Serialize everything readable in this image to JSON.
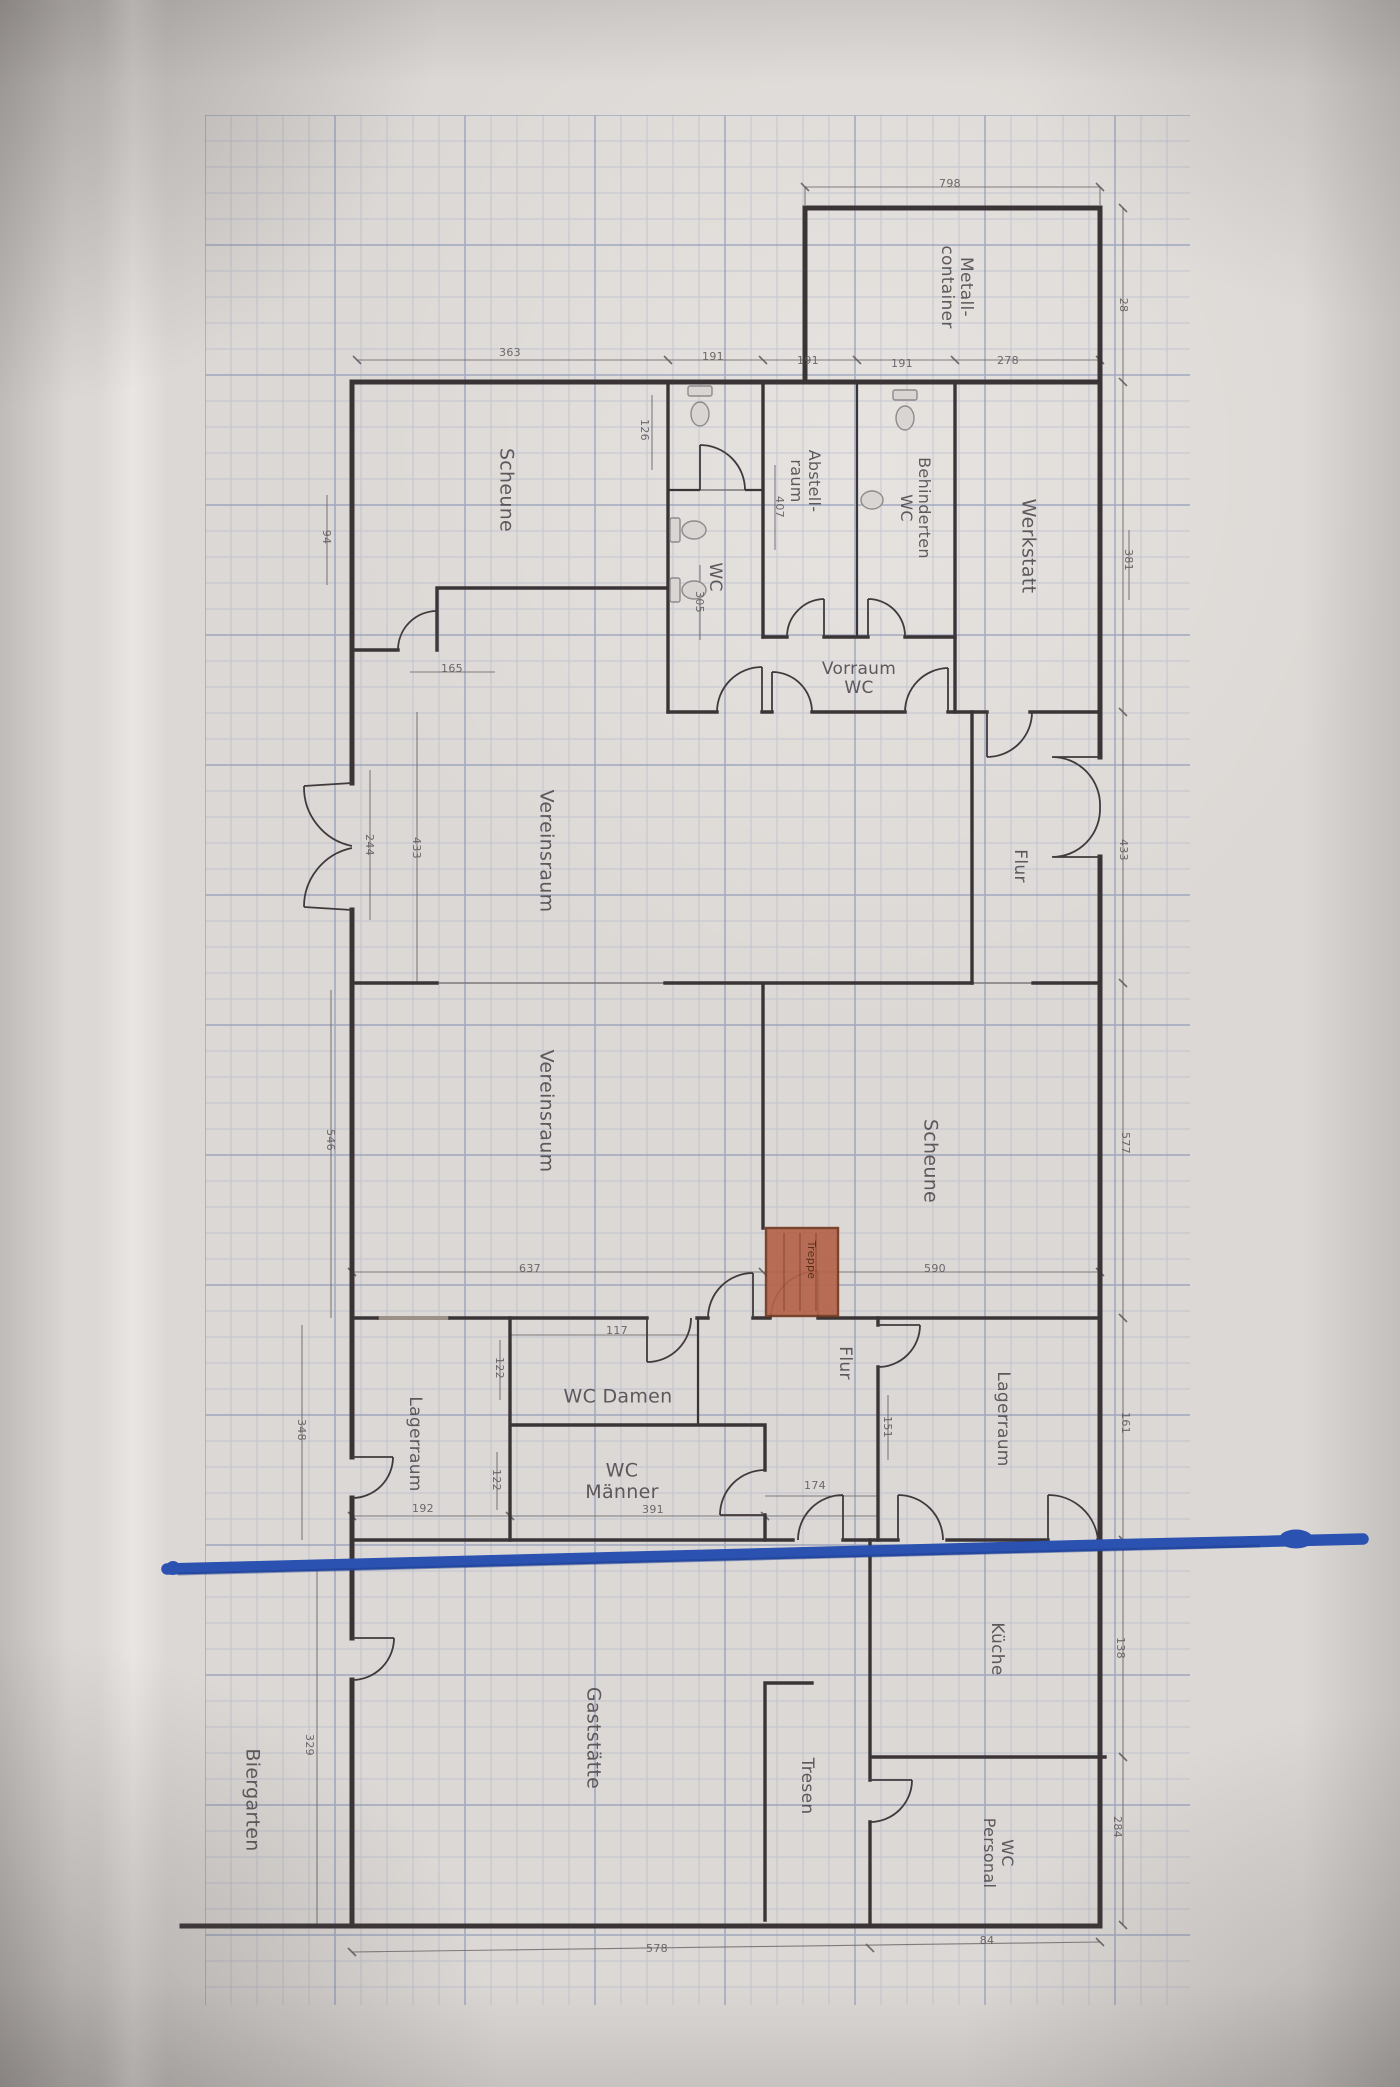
{
  "meta": {
    "description": "Photograph of a printed German floor plan (Grundriss) drawn on blue graph paper, plan rotated 90 degrees, with a hand-drawn blue marker line across the lower part",
    "language": "de"
  },
  "colors": {
    "paper": "#dcd8d5",
    "grid_minor": "#a9b0c9",
    "grid_major": "#8690b4",
    "wall": "#3a3436",
    "label_text": "#4c464a",
    "dim_text": "#5d575a",
    "stairs_fill": "#b4644a",
    "stairs_border": "#74381f",
    "stairs_text": "#4f2417",
    "marker_blue": "#2b52b0",
    "marker_blue_dark": "#1d3c8c"
  },
  "rooms": [
    {
      "id": "metallcontainer",
      "lines": [
        "Metall-",
        "container"
      ],
      "x": 958,
      "y": 287,
      "orient": "v",
      "font": 17
    },
    {
      "id": "scheune-top",
      "text": "Scheune",
      "x": 507,
      "y": 490,
      "orient": "v",
      "font": 19
    },
    {
      "id": "wc-upper",
      "text": "WC",
      "x": 716,
      "y": 577,
      "orient": "v",
      "font": 17
    },
    {
      "id": "abstellraum",
      "lines": [
        "Abstell-",
        "raum"
      ],
      "x": 806,
      "y": 481,
      "orient": "v",
      "font": 16
    },
    {
      "id": "behinderten-wc",
      "lines": [
        "Behinderten",
        "WC"
      ],
      "x": 916,
      "y": 508,
      "orient": "v",
      "font": 16
    },
    {
      "id": "werkstatt",
      "text": "Werkstatt",
      "x": 1029,
      "y": 546,
      "orient": "v",
      "font": 19
    },
    {
      "id": "vorraum-wc",
      "lines": [
        "Vorraum",
        "WC"
      ],
      "x": 859,
      "y": 677,
      "orient": "h",
      "font": 17
    },
    {
      "id": "flur-oben",
      "text": "Flur",
      "x": 1021,
      "y": 866,
      "orient": "v",
      "font": 17
    },
    {
      "id": "vereinsraum-1",
      "text": "Vereinsraum",
      "x": 547,
      "y": 851,
      "orient": "v",
      "font": 19
    },
    {
      "id": "vereinsraum-2",
      "text": "Vereinsraum",
      "x": 547,
      "y": 1111,
      "orient": "v",
      "font": 19
    },
    {
      "id": "scheune-mitte",
      "text": "Scheune",
      "x": 931,
      "y": 1161,
      "orient": "v",
      "font": 19
    },
    {
      "id": "treppe",
      "text": "Treppe",
      "x": 812,
      "y": 1260,
      "orient": "v",
      "font": 11,
      "color": "#4f2417"
    },
    {
      "id": "lagerraum-links",
      "text": "Lagerraum",
      "x": 416,
      "y": 1444,
      "orient": "v",
      "font": 17
    },
    {
      "id": "wc-damen",
      "text": "WC Damen",
      "x": 618,
      "y": 1396,
      "orient": "h",
      "font": 19
    },
    {
      "id": "wc-maenner",
      "lines": [
        "WC",
        "Männer"
      ],
      "x": 622,
      "y": 1480,
      "orient": "h",
      "font": 19
    },
    {
      "id": "flur-unten",
      "text": "Flur",
      "x": 846,
      "y": 1363,
      "orient": "v",
      "font": 17
    },
    {
      "id": "lagerraum-rechts",
      "text": "Lagerraum",
      "x": 1004,
      "y": 1419,
      "orient": "v",
      "font": 17
    },
    {
      "id": "gaststaette",
      "text": "Gaststätte",
      "x": 594,
      "y": 1738,
      "orient": "v",
      "font": 19
    },
    {
      "id": "kueche",
      "text": "Küche",
      "x": 998,
      "y": 1649,
      "orient": "v",
      "font": 17
    },
    {
      "id": "tresen",
      "text": "Tresen",
      "x": 808,
      "y": 1786,
      "orient": "v",
      "font": 17
    },
    {
      "id": "wc-personal",
      "lines": [
        "WC",
        "Personal"
      ],
      "x": 999,
      "y": 1853,
      "orient": "v",
      "font": 16
    },
    {
      "id": "biergarten",
      "text": "Biergarten",
      "x": 253,
      "y": 1800,
      "orient": "v",
      "font": 19
    }
  ],
  "dimensions": [
    {
      "text": "798",
      "x": 950,
      "y": 183,
      "orient": "h"
    },
    {
      "text": "363",
      "x": 510,
      "y": 352,
      "orient": "h"
    },
    {
      "text": "191",
      "x": 713,
      "y": 356,
      "orient": "h"
    },
    {
      "text": "191",
      "x": 808,
      "y": 360,
      "orient": "h"
    },
    {
      "text": "191",
      "x": 902,
      "y": 363,
      "orient": "h"
    },
    {
      "text": "278",
      "x": 1008,
      "y": 360,
      "orient": "h"
    },
    {
      "text": "28",
      "x": 1124,
      "y": 305,
      "orient": "v"
    },
    {
      "text": "381",
      "x": 1129,
      "y": 560,
      "orient": "v"
    },
    {
      "text": "433",
      "x": 1124,
      "y": 850,
      "orient": "v"
    },
    {
      "text": "577",
      "x": 1126,
      "y": 1143,
      "orient": "v"
    },
    {
      "text": "161",
      "x": 1126,
      "y": 1423,
      "orient": "v"
    },
    {
      "text": "138",
      "x": 1121,
      "y": 1648,
      "orient": "v"
    },
    {
      "text": "284",
      "x": 1118,
      "y": 1827,
      "orient": "v"
    },
    {
      "text": "94",
      "x": 327,
      "y": 537,
      "orient": "v"
    },
    {
      "text": "126",
      "x": 645,
      "y": 430,
      "orient": "v"
    },
    {
      "text": "407",
      "x": 780,
      "y": 507,
      "orient": "v"
    },
    {
      "text": "305",
      "x": 700,
      "y": 602,
      "orient": "v"
    },
    {
      "text": "165",
      "x": 452,
      "y": 668,
      "orient": "h"
    },
    {
      "text": "244",
      "x": 370,
      "y": 845,
      "orient": "v"
    },
    {
      "text": "433",
      "x": 417,
      "y": 848,
      "orient": "v"
    },
    {
      "text": "546",
      "x": 331,
      "y": 1140,
      "orient": "v"
    },
    {
      "text": "637",
      "x": 530,
      "y": 1268,
      "orient": "h"
    },
    {
      "text": "590",
      "x": 935,
      "y": 1268,
      "orient": "h"
    },
    {
      "text": "117",
      "x": 617,
      "y": 1330,
      "orient": "h"
    },
    {
      "text": "122",
      "x": 500,
      "y": 1368,
      "orient": "v"
    },
    {
      "text": "122",
      "x": 497,
      "y": 1480,
      "orient": "v"
    },
    {
      "text": "151",
      "x": 888,
      "y": 1427,
      "orient": "v"
    },
    {
      "text": "174",
      "x": 815,
      "y": 1485,
      "orient": "h"
    },
    {
      "text": "192",
      "x": 423,
      "y": 1508,
      "orient": "h"
    },
    {
      "text": "391",
      "x": 653,
      "y": 1509,
      "orient": "h"
    },
    {
      "text": "348",
      "x": 302,
      "y": 1430,
      "orient": "v"
    },
    {
      "text": "329",
      "x": 310,
      "y": 1745,
      "orient": "v"
    },
    {
      "text": "578",
      "x": 657,
      "y": 1948,
      "orient": "h"
    },
    {
      "text": "84",
      "x": 987,
      "y": 1940,
      "orient": "h"
    }
  ],
  "stairs": {
    "label": "Treppe",
    "x": 766,
    "y": 1228,
    "w": 72,
    "h": 88
  },
  "blue_marker": {
    "start_x": 167,
    "start_y": 1569,
    "end_x": 1363,
    "end_y": 1539,
    "blob_x": 1296,
    "blob_y": 1539
  }
}
